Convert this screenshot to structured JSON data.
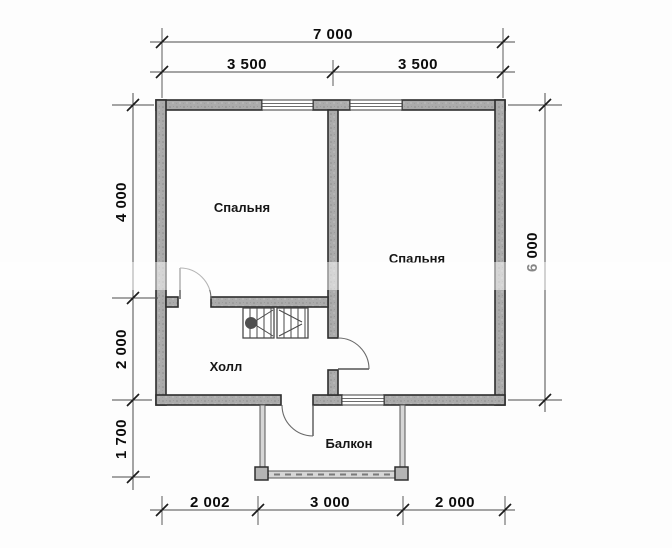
{
  "plan": {
    "rooms": {
      "bedroom_left": "Спальня",
      "bedroom_right": "Спальня",
      "hall": "Холл",
      "balcony": "Балкон"
    },
    "dimensions": {
      "top_total": "7 000",
      "top_left_half": "3 500",
      "top_right_half": "3 500",
      "side_left_upper": "4 000",
      "side_left_lower": "2 000",
      "side_left_balcony": "1 700",
      "side_right_total": "6 000",
      "bottom_left": "2 002",
      "bottom_center": "3 000",
      "bottom_right": "2 000"
    },
    "colors": {
      "wall_fill": "#ababab",
      "wall_outline": "#2e2e2e",
      "dimension_line": "#4a4a4a",
      "text": "#0c0c0c",
      "background": "#fdfdfd"
    }
  }
}
